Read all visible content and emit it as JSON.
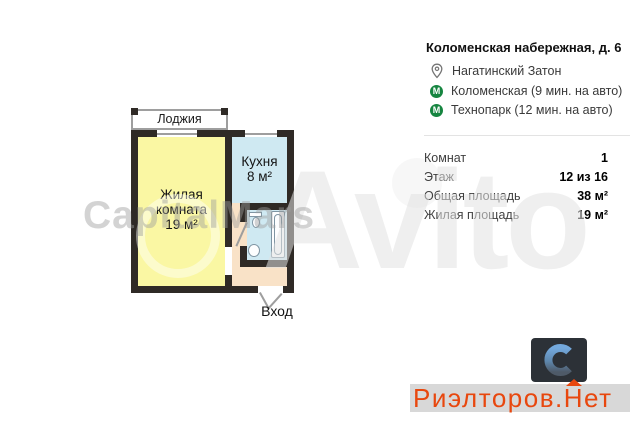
{
  "plan": {
    "loggia_label": "Лоджия",
    "living_room": {
      "line1": "Жилая",
      "line2": "комната",
      "area": "19 м²"
    },
    "kitchen": {
      "name": "Кухня",
      "area": "8 м²"
    },
    "entrance_label": "Вход",
    "colors": {
      "living": "#faf7a3",
      "kitchen": "#cfe9f2",
      "hallway": "#f9e2c7",
      "bathroom": "#cfe9f2",
      "walls": "#2f2a26"
    }
  },
  "watermarks": {
    "agency": "CapitalMars",
    "site": "Avito"
  },
  "details": {
    "address": "Коломенская набережная, д. 6",
    "district": "Нагатинский Затон",
    "metro_icon_letter": "М",
    "metro": [
      {
        "name": "Коломенская (9 мин. на авто)"
      },
      {
        "name": "Технопарк (12 мин. на авто)"
      }
    ],
    "rows": [
      {
        "label": "Комнат",
        "value": "1"
      },
      {
        "label": "Этаж",
        "value": "12 из 16"
      },
      {
        "label": "Общая площадь",
        "value": "38 м²"
      },
      {
        "label": "Жилая площадь",
        "value": "19 м²"
      }
    ]
  },
  "branding": {
    "site_prefix": "Риэлторов.",
    "site_house_letter": "Н",
    "site_suffix": "ет",
    "banner_text_color": "#e8470e",
    "banner_bg": "#d8d8d8",
    "logo_bg": "#2c3137",
    "metro_green": "#168540"
  }
}
